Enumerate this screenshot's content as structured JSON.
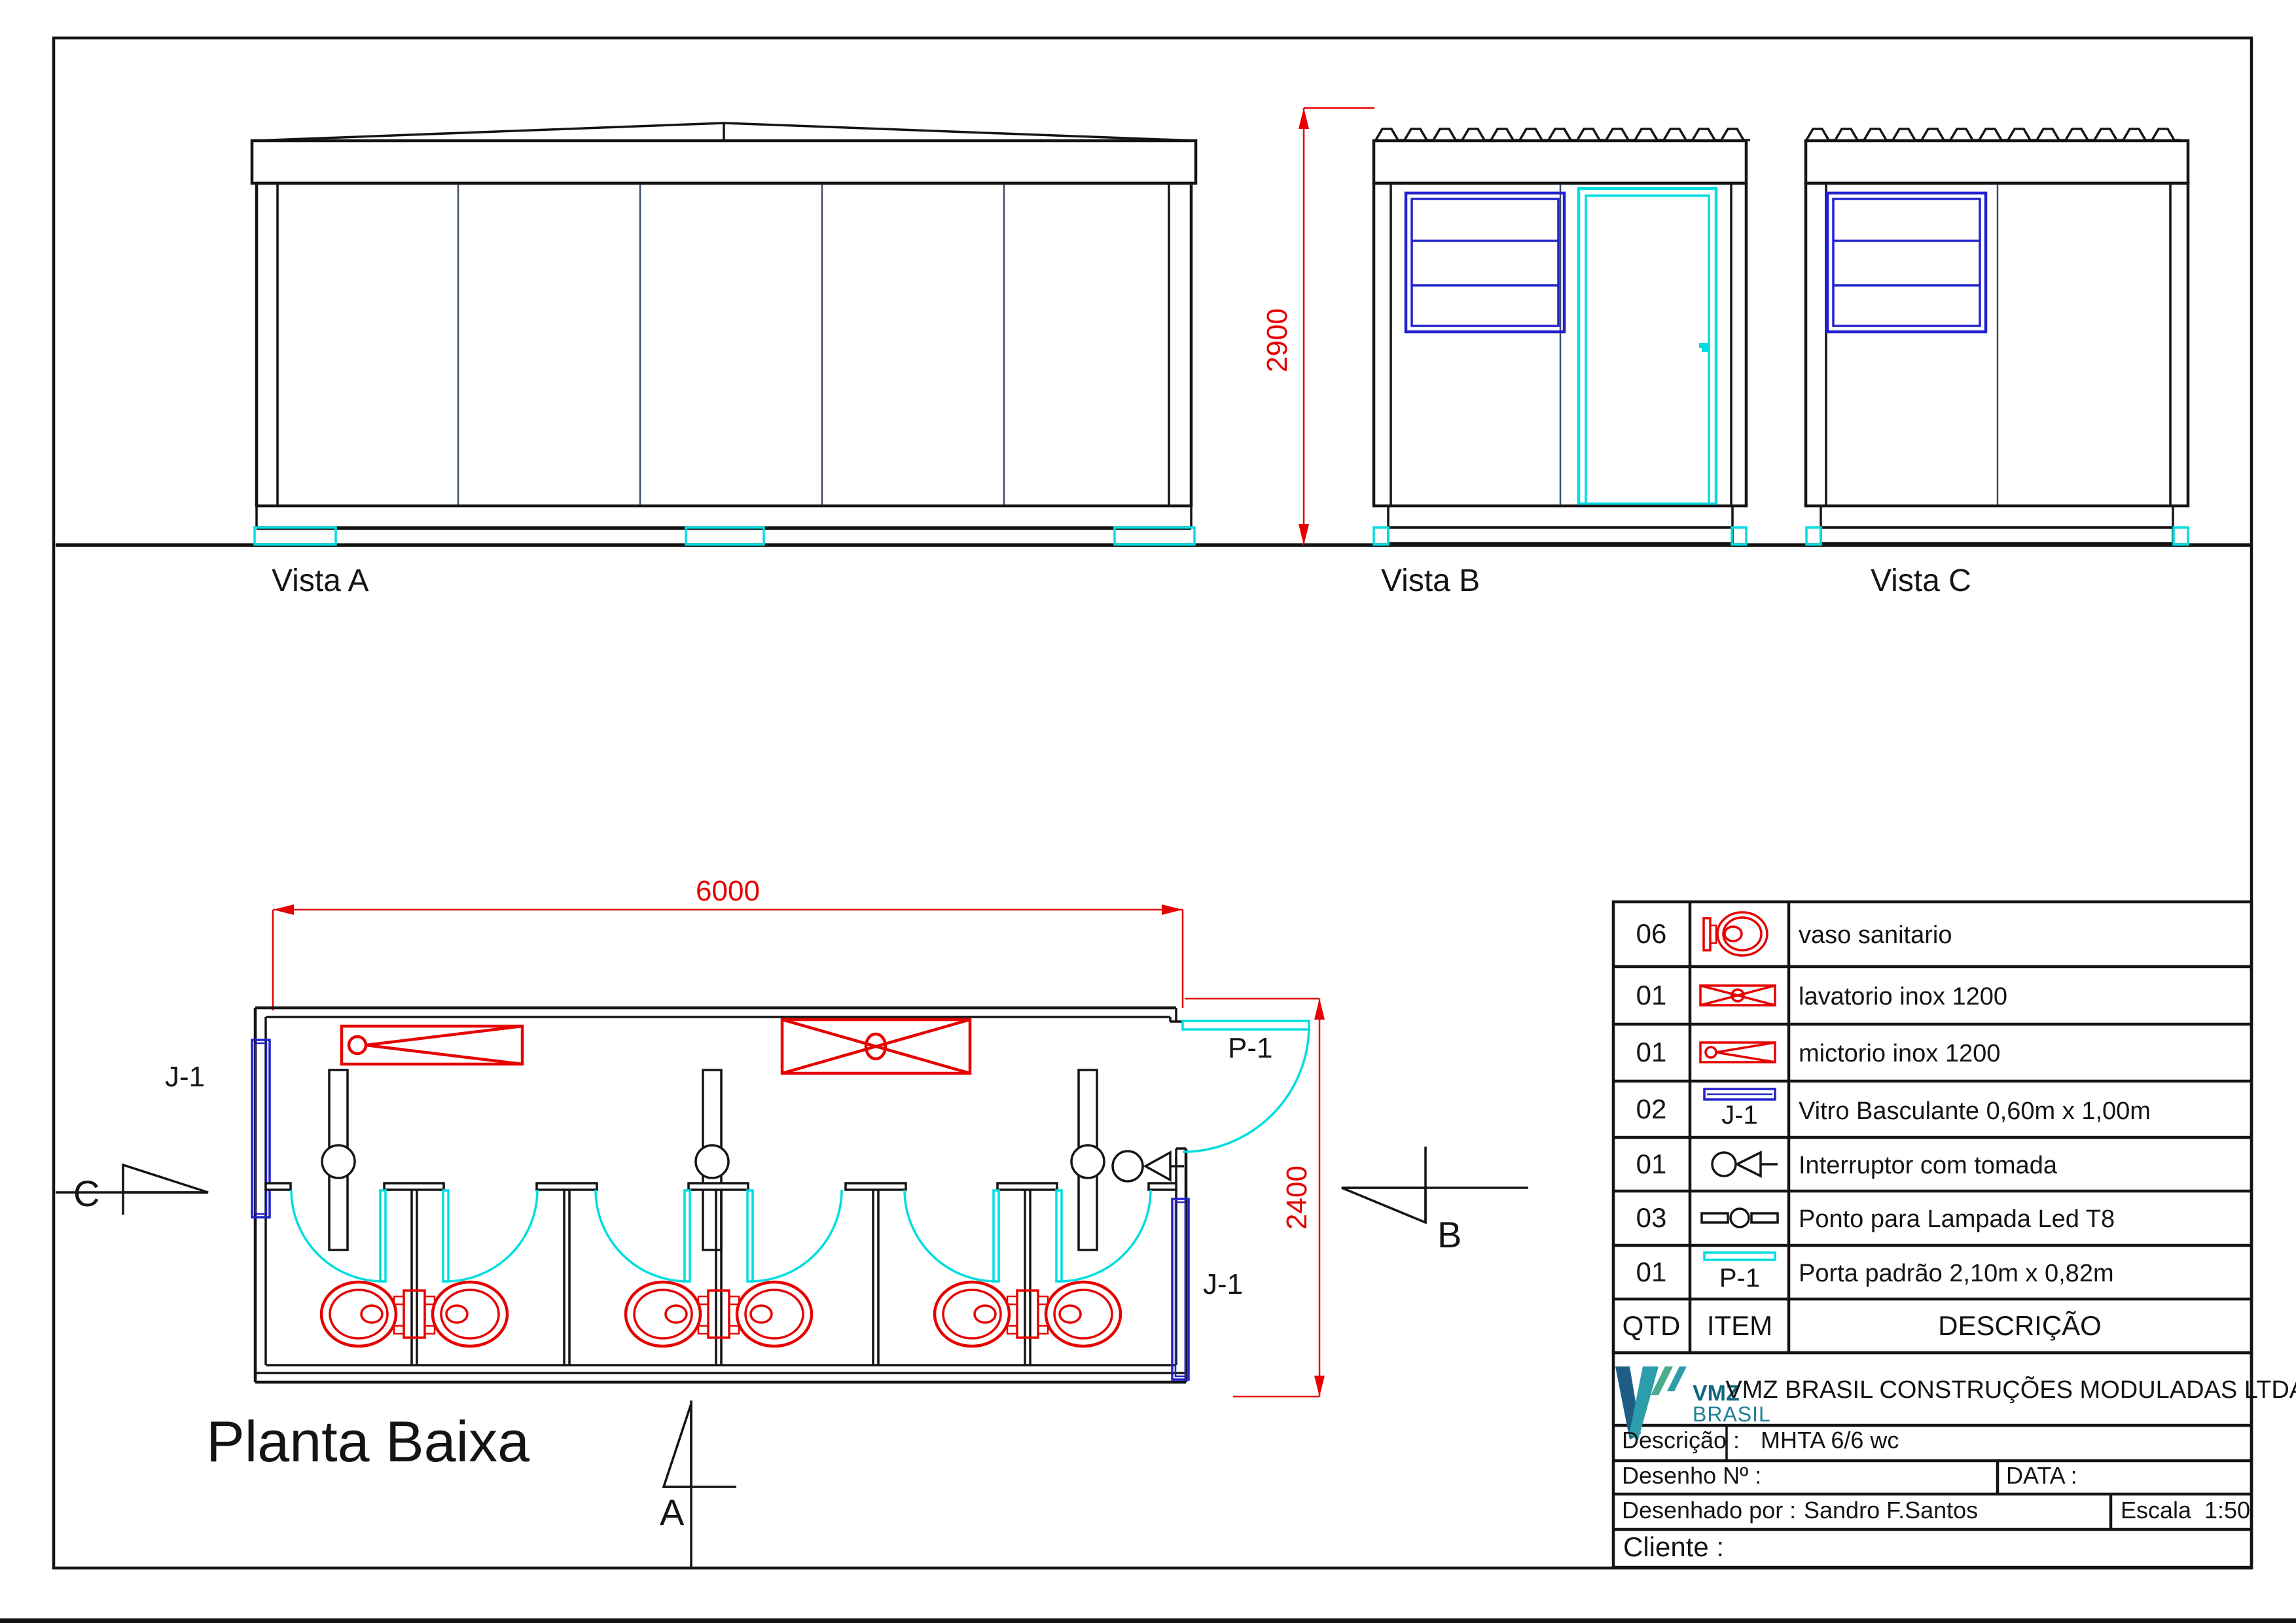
{
  "views": {
    "vista_a_label": "Vista A",
    "vista_b_label": "Vista B",
    "vista_c_label": "Vista C",
    "plan_label": "Planta Baixa"
  },
  "dims": {
    "width": "6000",
    "depth": "2400",
    "height": "2900"
  },
  "tags": {
    "window": "J-1",
    "door": "P-1"
  },
  "section_markers": {
    "a": "A",
    "b": "B",
    "c": "C"
  },
  "legend": {
    "headers": {
      "qty": "QTD",
      "item": "ITEM",
      "description": "DESCRIÇÃO"
    },
    "rows": [
      {
        "qty": "06",
        "icon": "toilet-plan-icon",
        "description": "vaso sanitario"
      },
      {
        "qty": "01",
        "icon": "sink-icon",
        "description": "lavatorio inox 1200"
      },
      {
        "qty": "01",
        "icon": "urinal-icon",
        "description": "mictorio  inox 1200"
      },
      {
        "qty": "02",
        "icon": "window-icon",
        "item_tag": "J-1",
        "description": "Vitro Basculante 0,60m x 1,00m"
      },
      {
        "qty": "01",
        "icon": "switch-outlet-icon",
        "description": "Interruptor com tomada"
      },
      {
        "qty": "03",
        "icon": "led-lamp-icon",
        "description": "Ponto para Lampada Led T8"
      },
      {
        "qty": "01",
        "icon": "door-icon",
        "item_tag": "P-1",
        "description": "Porta padrão  2,10m x 0,82m"
      }
    ]
  },
  "title_block": {
    "logo": {
      "name": "VMZ",
      "country": "BRASIL"
    },
    "company": "VMZ BRASIL CONSTRUÇÕES MODULADAS LTDA.",
    "description_label": "Descrição :",
    "description_value": "MHTA 6/6 wc",
    "drawing_number_label": "Desenho  Nº :",
    "date_label": "DATA :",
    "drawn_by_label": "Desenhado por  :",
    "drawn_by_value": "Sandro F.Santos",
    "scale_label": "Escala",
    "scale_value": "1:50",
    "client_label": "Cliente :"
  },
  "colors": {
    "fixture_red": "#e60000",
    "joinery_cyan": "#00dde0",
    "window_blue": "#2222cd",
    "line_black": "#141414",
    "logo_teal": "#1d7f97",
    "logo_dark": "#1e5e86",
    "logo_green": "#49ad8e"
  }
}
